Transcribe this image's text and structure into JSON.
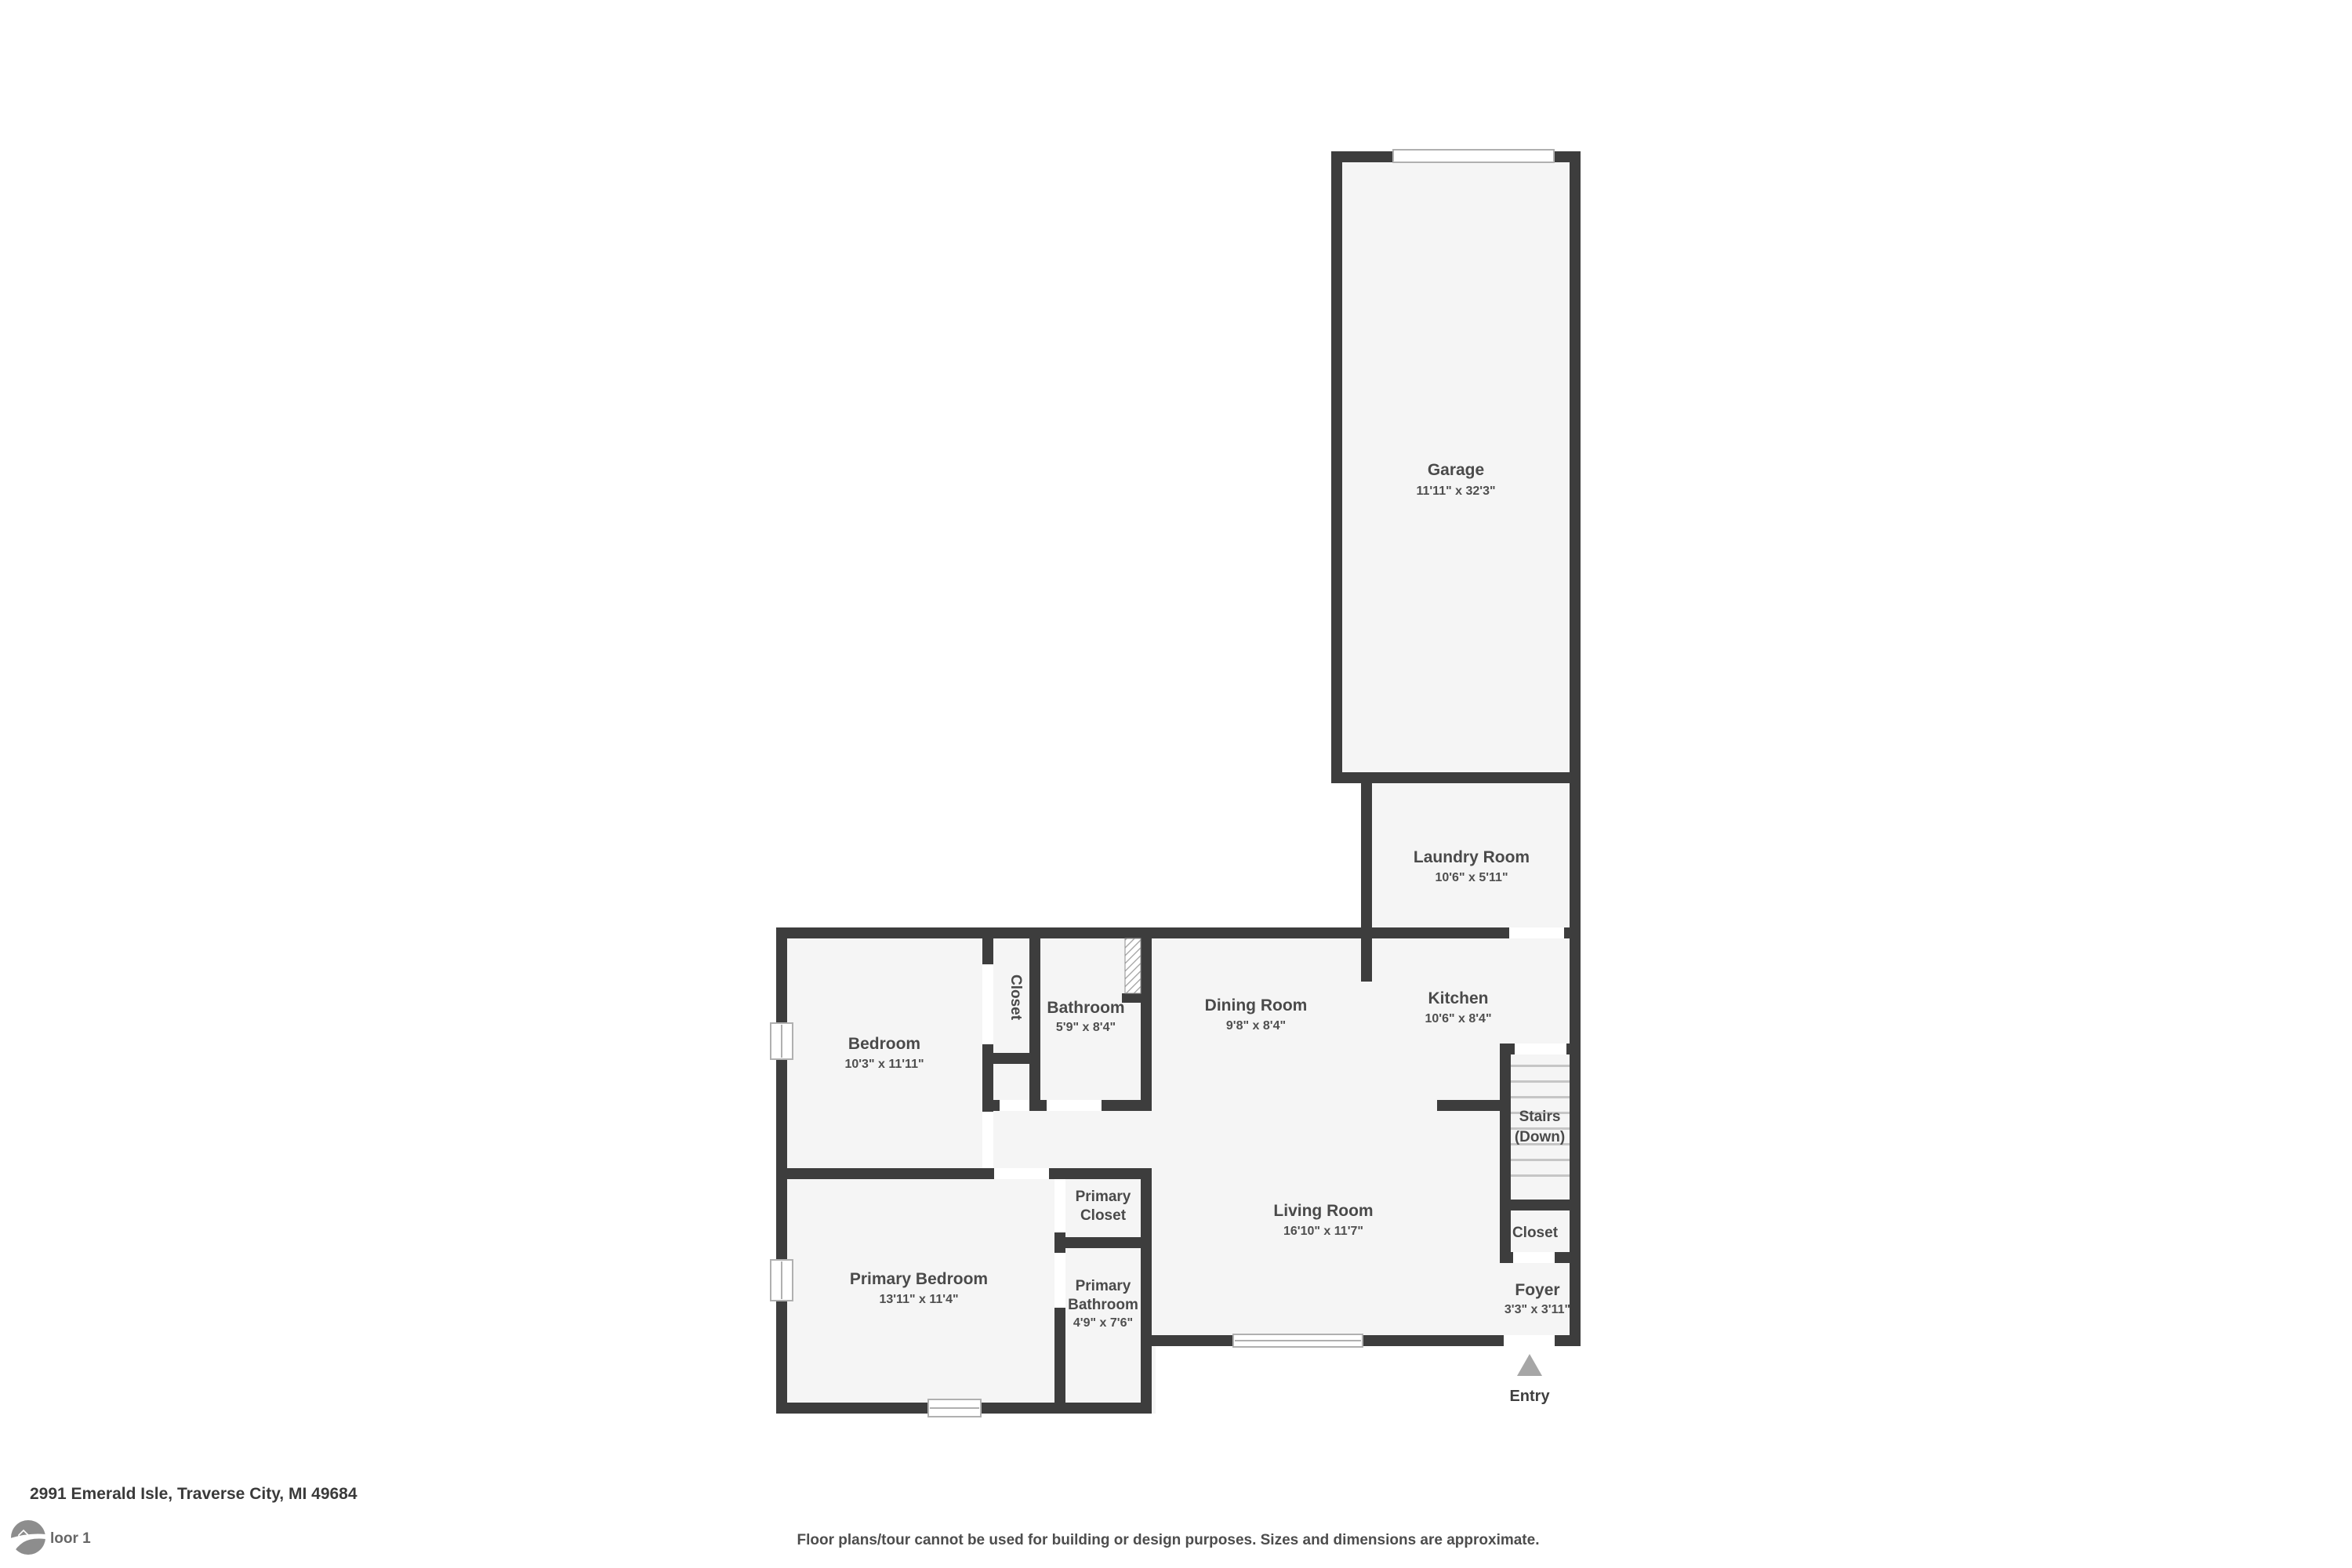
{
  "page": {
    "address": "2991 Emerald Isle, Traverse City, MI 49684",
    "floor_label": "loor 1",
    "disclaimer": "Floor plans/tour cannot be used for building or design purposes. Sizes and dimensions are approximate.",
    "entry_label": "Entry"
  },
  "colors": {
    "wall": "#3d3d3d",
    "floor_fill": "#f5f5f5",
    "label_text": "#4a4a4a",
    "entry_arrow": "#a6a6a6",
    "logo_gray": "#8d8d8d"
  },
  "rooms": {
    "garage": {
      "name": "Garage",
      "dims": "11'11\" x 32'3\""
    },
    "laundry": {
      "name": "Laundry Room",
      "dims": "10'6\" x 5'11\""
    },
    "kitchen": {
      "name": "Kitchen",
      "dims": "10'6\" x 8'4\""
    },
    "dining": {
      "name": "Dining Room",
      "dims": "9'8\" x 8'4\""
    },
    "bathroom": {
      "name": "Bathroom",
      "dims": "5'9\" x 8'4\""
    },
    "hall_closet": {
      "name": "Closet"
    },
    "bedroom": {
      "name": "Bedroom",
      "dims": "10'3\" x 11'11\""
    },
    "primary_bedroom": {
      "name": "Primary Bedroom",
      "dims": "13'11\" x 11'4\""
    },
    "primary_closet": {
      "line1": "Primary",
      "line2": "Closet"
    },
    "primary_bathroom": {
      "line1": "Primary",
      "line2": "Bathroom",
      "dims": "4'9\" x 7'6\""
    },
    "living": {
      "name": "Living Room",
      "dims": "16'10\" x 11'7\""
    },
    "stairs": {
      "line1": "Stairs",
      "line2": "(Down)"
    },
    "entry_closet": {
      "name": "Closet"
    },
    "foyer": {
      "name": "Foyer",
      "dims": "3'3\" x 3'11\""
    }
  }
}
